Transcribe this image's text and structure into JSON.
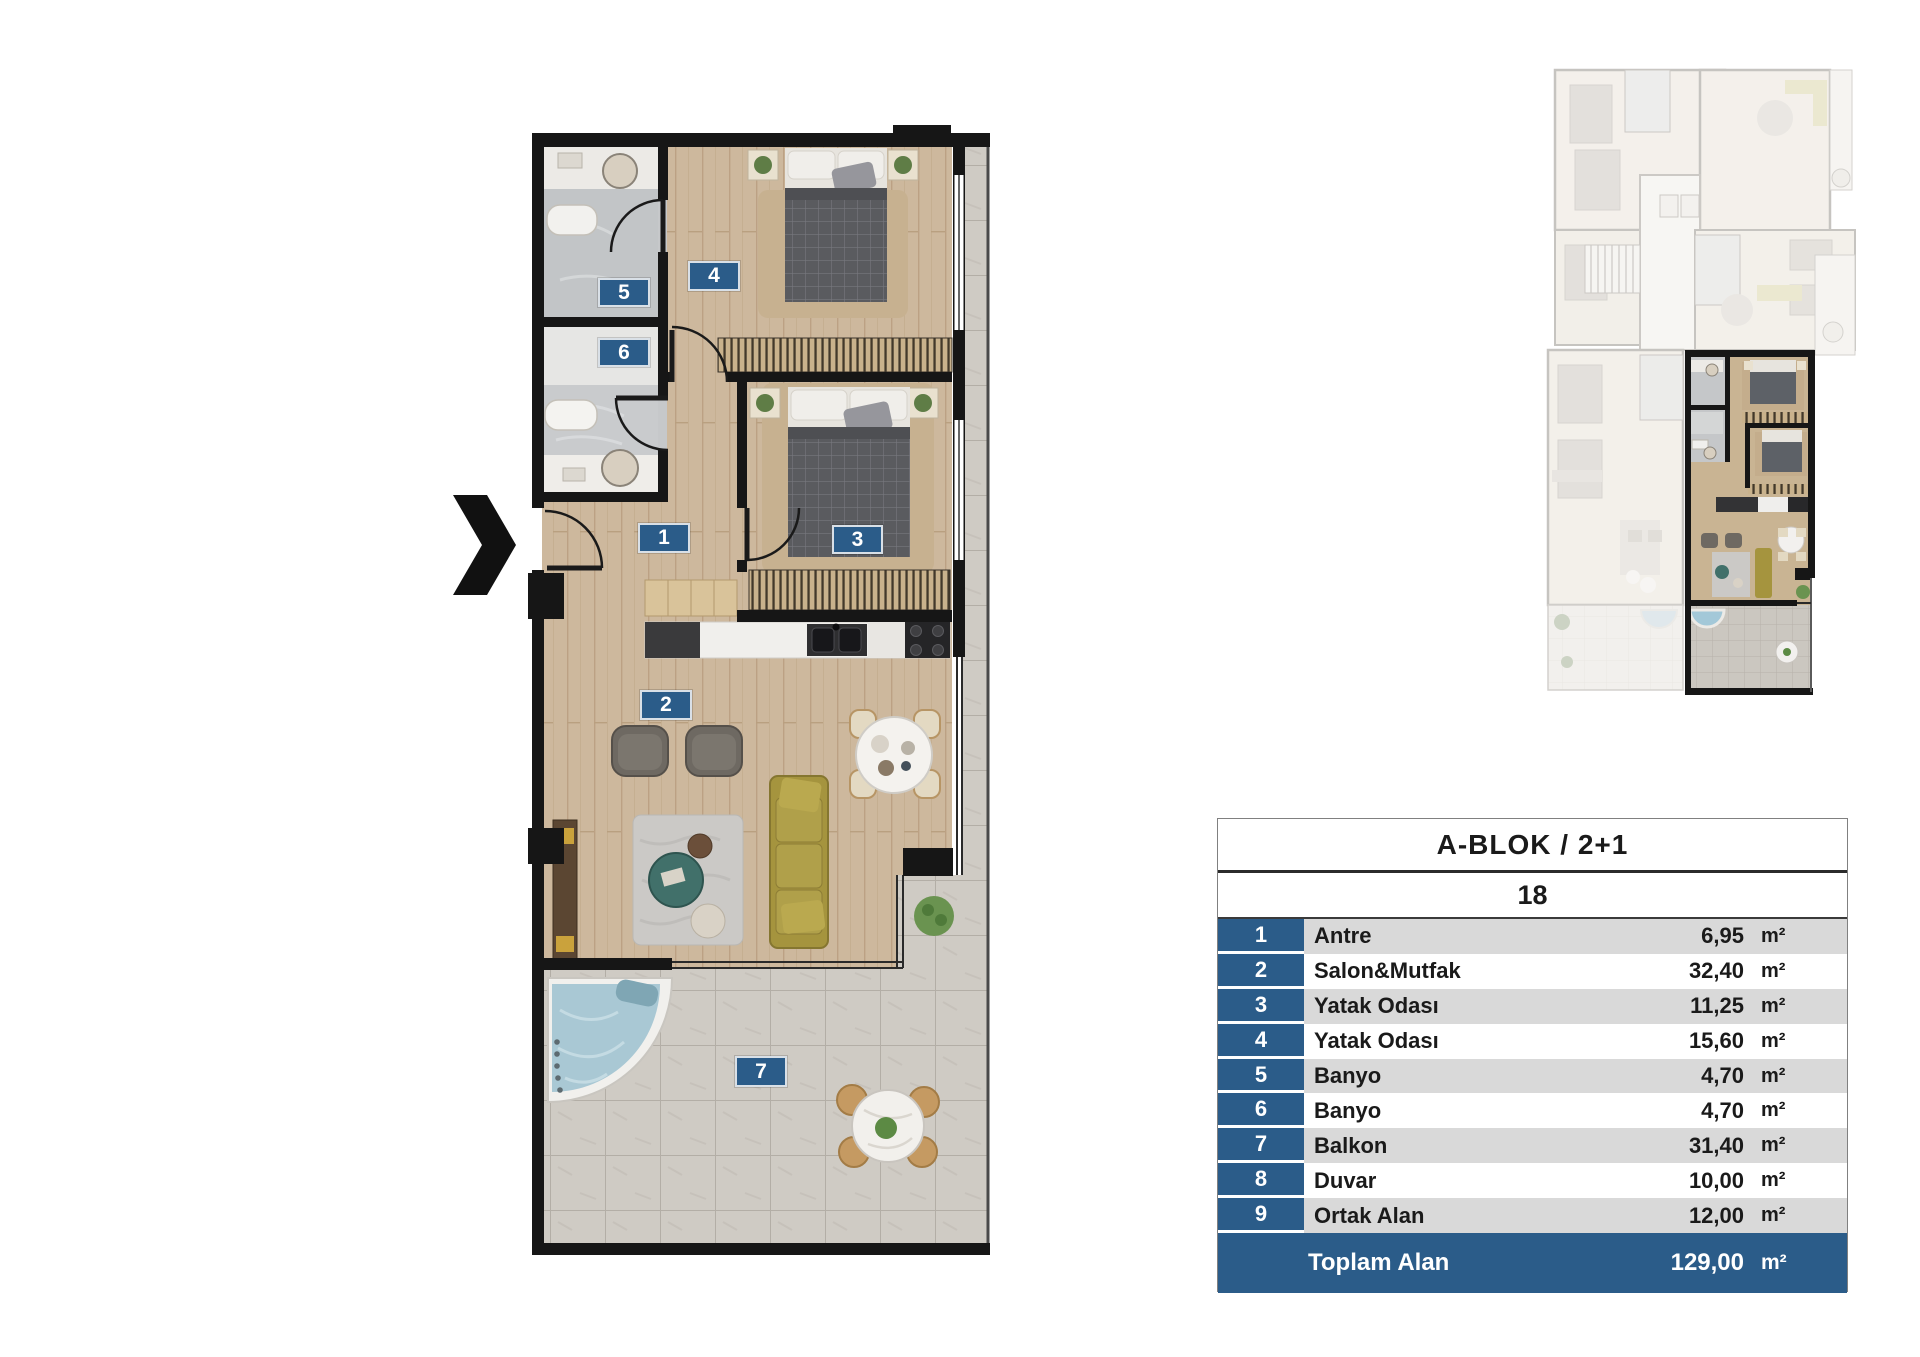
{
  "floor_plan": {
    "entry_arrow": "right-chevron",
    "room_badges": [
      {
        "number": "1"
      },
      {
        "number": "2"
      },
      {
        "number": "3"
      },
      {
        "number": "4"
      },
      {
        "number": "5"
      },
      {
        "number": "6"
      },
      {
        "number": "7"
      }
    ]
  },
  "unit_table": {
    "block_title": "A-BLOK / 2+1",
    "unit_number": "18",
    "rows": [
      {
        "no": "1",
        "label": "Antre",
        "value": "6,95",
        "unit": "m²"
      },
      {
        "no": "2",
        "label": "Salon&Mutfak",
        "value": "32,40",
        "unit": "m²"
      },
      {
        "no": "3",
        "label": "Yatak Odası",
        "value": "11,25",
        "unit": "m²"
      },
      {
        "no": "4",
        "label": "Yatak Odası",
        "value": "15,60",
        "unit": "m²"
      },
      {
        "no": "5",
        "label": "Banyo",
        "value": "4,70",
        "unit": "m²"
      },
      {
        "no": "6",
        "label": "Banyo",
        "value": "4,70",
        "unit": "m²"
      },
      {
        "no": "7",
        "label": "Balkon",
        "value": "31,40",
        "unit": "m²"
      },
      {
        "no": "8",
        "label": "Duvar",
        "value": "10,00",
        "unit": "m²"
      },
      {
        "no": "9",
        "label": "Ortak Alan",
        "value": "12,00",
        "unit": "m²"
      }
    ],
    "total": {
      "label": "Toplam Alan",
      "value": "129,00",
      "unit": "m²"
    }
  },
  "colors": {
    "accent_blue": "#2b5c89",
    "row_grey": "#d9d9d9",
    "wall_black": "#161616",
    "wood": "#cdb89d",
    "tile_grey": "#cfcbc4",
    "sofa_olive": "#a5943e",
    "tub_water": "#a9c8d4"
  }
}
